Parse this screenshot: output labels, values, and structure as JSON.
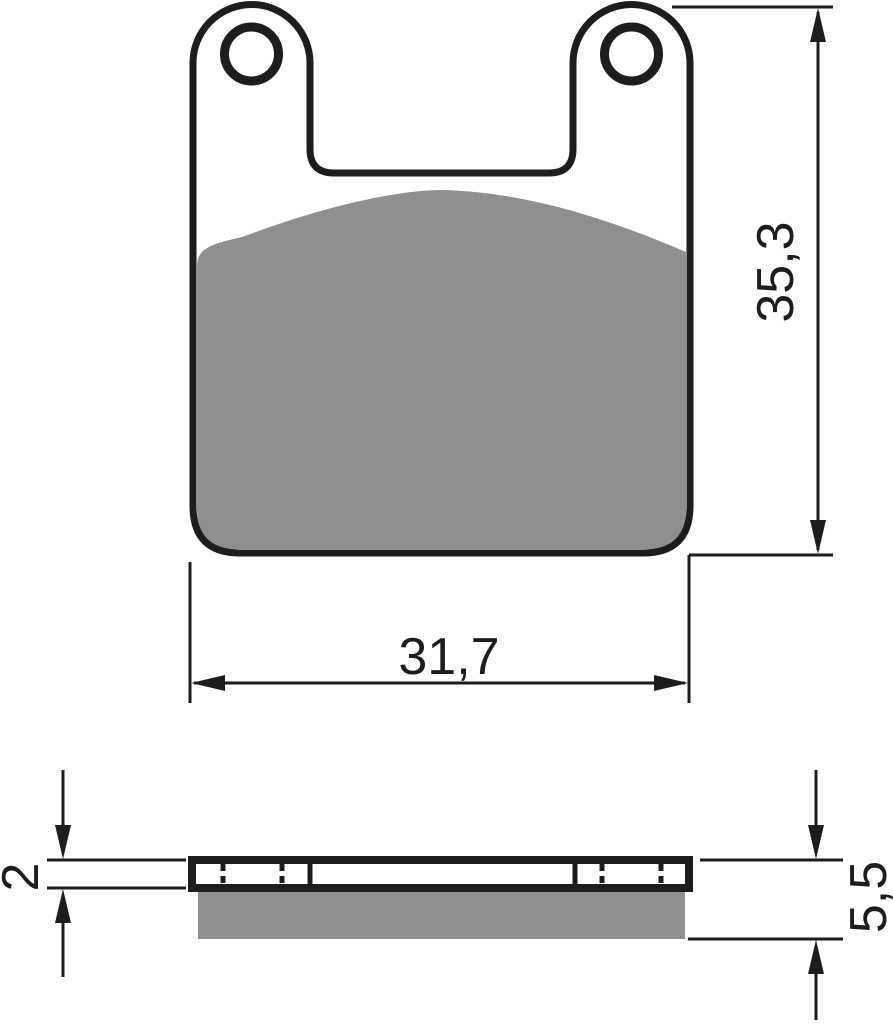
{
  "drawing": {
    "front_view": {
      "height_dimension_label": "35,3",
      "width_dimension_label": "31,7"
    },
    "side_view": {
      "backplate_thickness_label": "2",
      "total_thickness_label": "5,5"
    }
  },
  "colors": {
    "outline": "#1d1d1b",
    "friction_material": "#8f8f8f",
    "dimension_lines": "#1d1d1b",
    "background": "#ffffff"
  }
}
